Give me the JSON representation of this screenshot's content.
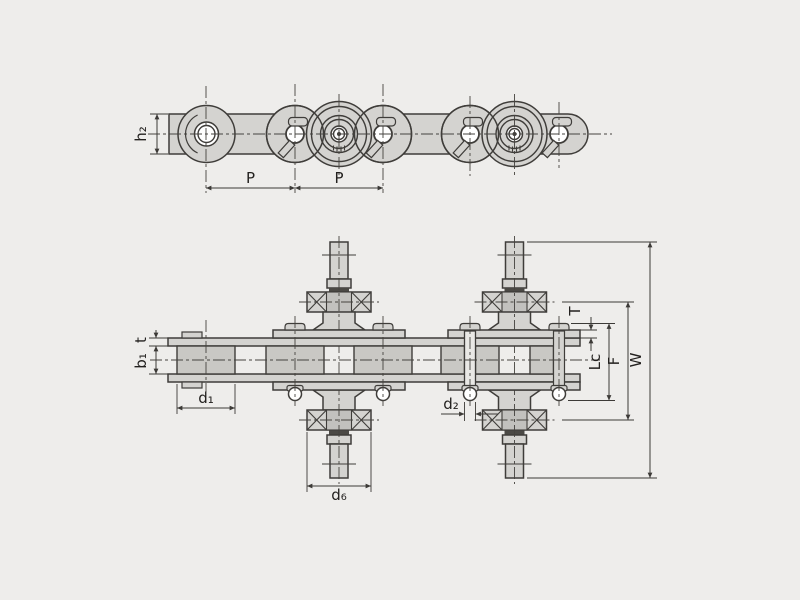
{
  "drawing": {
    "type": "engineering-diagram",
    "subject": "conveyor roller chain with double-extended bearing pins, side elevation and plan view",
    "colors": {
      "background": "#eeedeb",
      "line": "#3f3d3a",
      "part_fill": "#d4d3d0",
      "roller_fill": "#c9c8c4",
      "dark_band": "#4b4945"
    },
    "side_view": {
      "labels": {
        "pitch_1": "P",
        "pitch_2": "P",
        "plate_height": "h₂"
      }
    },
    "plan_view": {
      "labels": {
        "inner_width": "b₁",
        "plate_thickness_inner": "t",
        "roller_diameter": "d₁",
        "pin_diameter": "d₂",
        "bearing_diameter": "d₆",
        "attachment_plate_thickness": "T",
        "pin_length": "Lc",
        "bearing_span": "F",
        "overall_width": "W"
      }
    }
  }
}
